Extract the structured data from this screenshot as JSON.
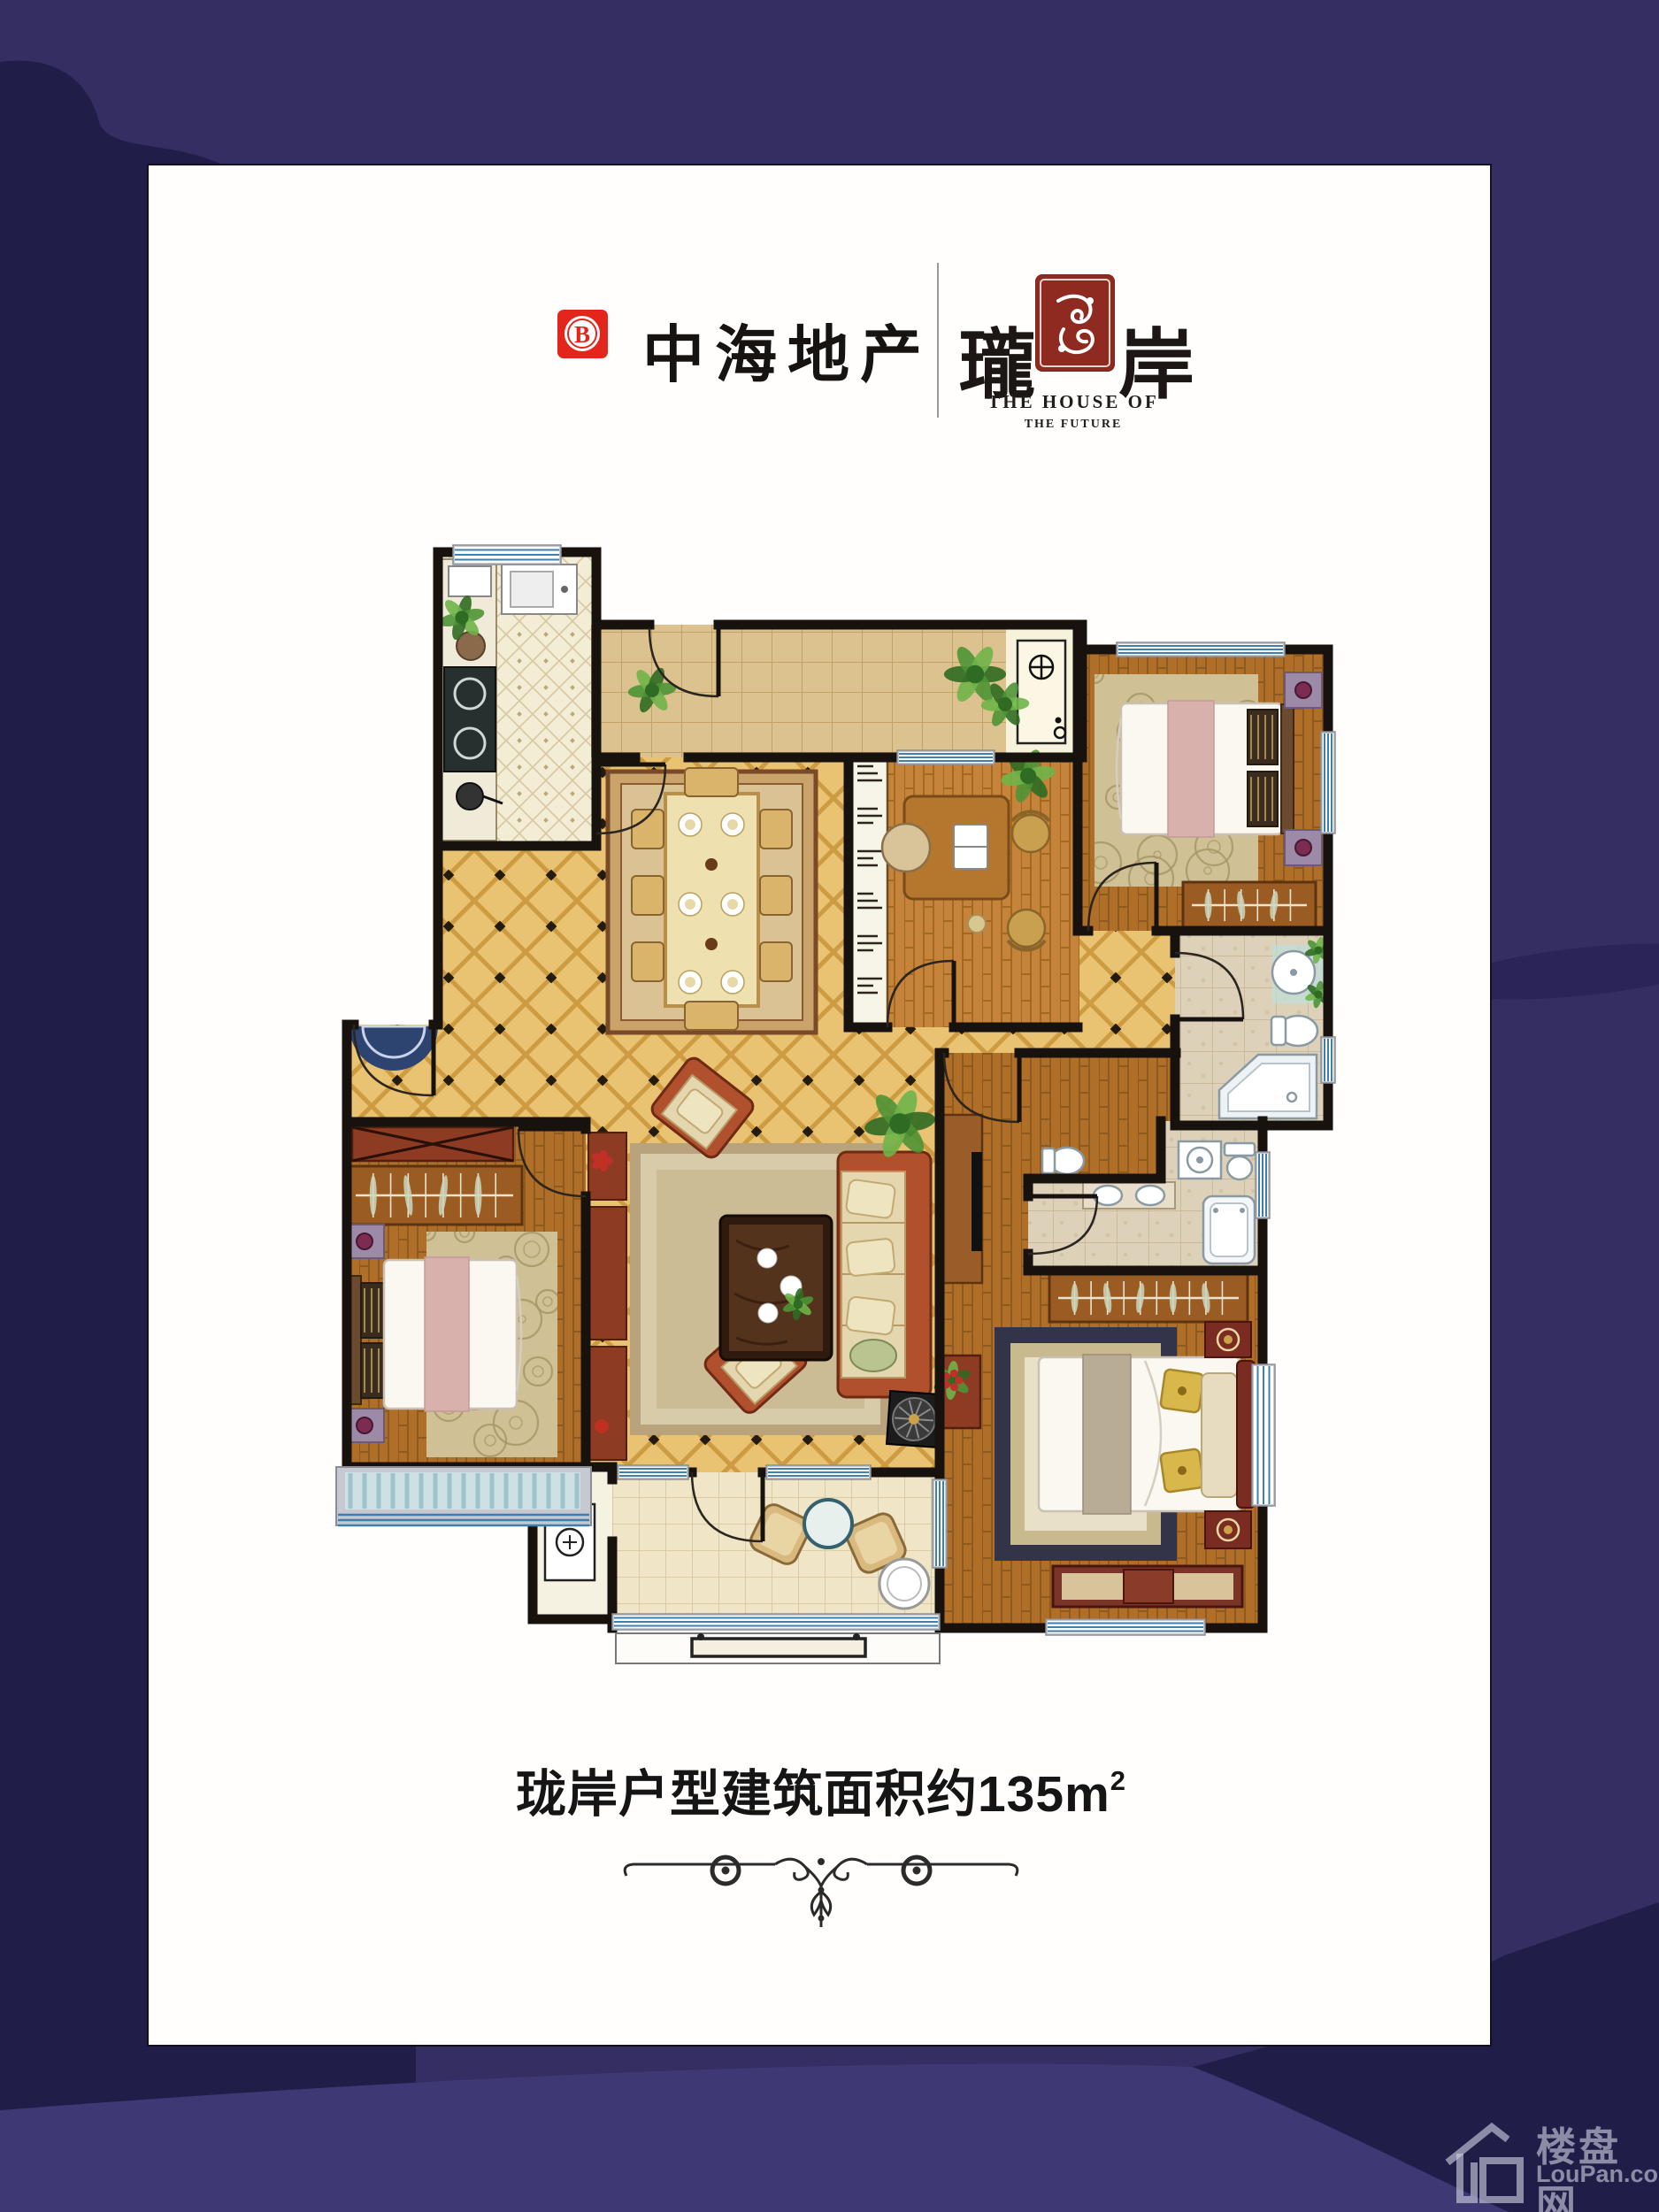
{
  "poster": {
    "background_color": "#352e63",
    "blob_color": "#211d49",
    "swath_color": "#3e3875",
    "card_color": "#fffefc",
    "header": {
      "brand_logo_letter": "B",
      "brand_logo_color": "#e2261c",
      "brand_name": "中海地产",
      "product_char_left": "瓏",
      "product_char_right": "岸",
      "seal_color": "#8e2a20",
      "tagline_line1": "THE HOUSE OF",
      "tagline_line2": "THE FUTURE"
    },
    "caption": {
      "prefix": "珑岸户型建筑面积约",
      "area_number": "135",
      "area_unit_base": "m",
      "area_unit_exponent": "2"
    },
    "watermark": {
      "name_cn": "楼盘网",
      "name_en": "LouPan.com"
    },
    "floorplan_palette": {
      "wall": "#17120e",
      "gold_tile": "#e9c272",
      "wood": "#b06f28",
      "kitchen_tile": "#f3ecd4",
      "marble": "#ded1b9",
      "window_blue": "#3f7fae"
    }
  }
}
